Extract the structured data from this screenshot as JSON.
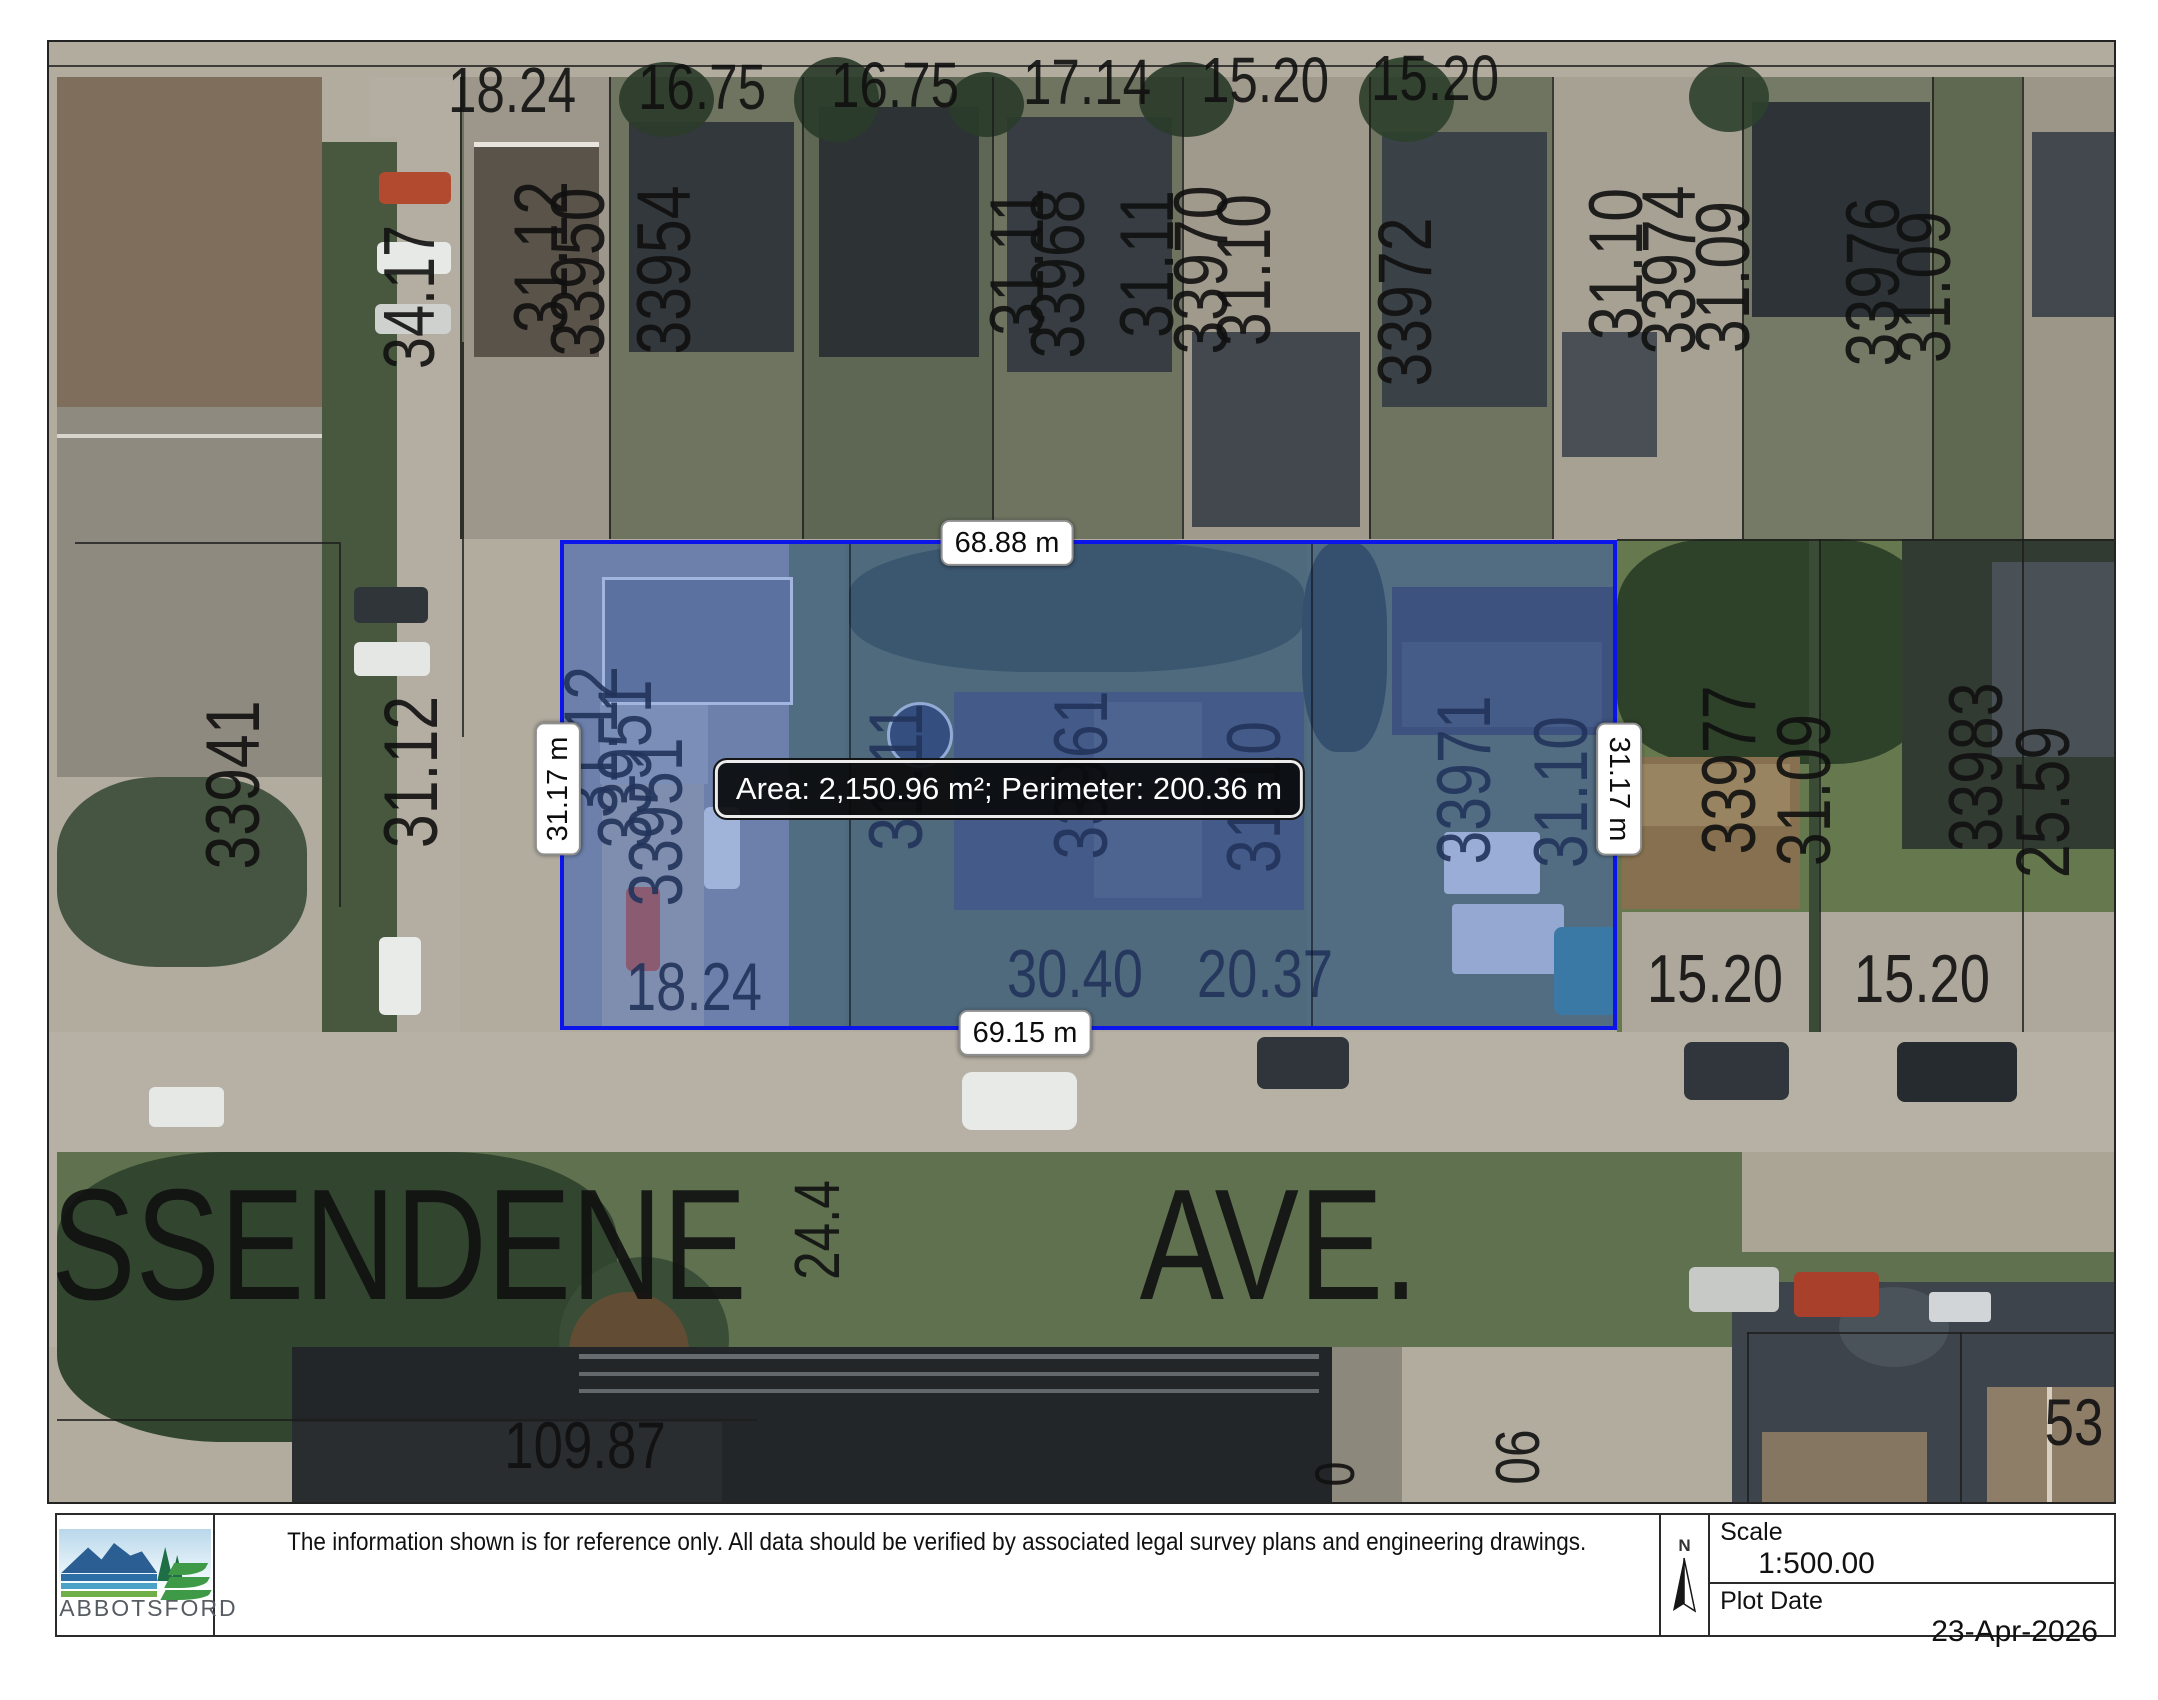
{
  "map": {
    "measurements": {
      "top": "68.88 m",
      "bottom": "69.15 m",
      "left": "31.17 m",
      "right": "31.17 m",
      "tooltip": "Area: 2,150.96 m²; Perimeter: 200.36 m"
    },
    "selection": {
      "area_m2": "2,150.96",
      "perimeter_m": "200.36"
    },
    "street_name": "SSENDENE  AVE.",
    "labels": [
      {
        "t": "18.24",
        "x": 463,
        "y": 48,
        "s": 64,
        "r": 0
      },
      {
        "t": "16.75",
        "x": 653,
        "y": 45,
        "s": 64,
        "r": 0
      },
      {
        "t": "16.75",
        "x": 846,
        "y": 43,
        "s": 64,
        "r": 0
      },
      {
        "t": "17.14",
        "x": 1038,
        "y": 40,
        "s": 64,
        "r": 0
      },
      {
        "t": "15.20",
        "x": 1216,
        "y": 38,
        "s": 64,
        "r": 0
      },
      {
        "t": "15.20",
        "x": 1386,
        "y": 36,
        "s": 64,
        "r": 0
      },
      {
        "t": "31.12",
        "x": 493,
        "y": 215,
        "s": 76,
        "r": -90
      },
      {
        "t": "33950",
        "x": 530,
        "y": 230,
        "s": 76,
        "r": -90
      },
      {
        "t": "33954",
        "x": 616,
        "y": 228,
        "s": 76,
        "r": -90
      },
      {
        "t": "31.11",
        "x": 969,
        "y": 220,
        "s": 76,
        "r": -90
      },
      {
        "t": "33968",
        "x": 1010,
        "y": 232,
        "s": 76,
        "r": -90
      },
      {
        "t": "31.11",
        "x": 1099,
        "y": 222,
        "s": 76,
        "r": -90
      },
      {
        "t": "33970",
        "x": 1153,
        "y": 228,
        "s": 76,
        "r": -90
      },
      {
        "t": "31.10",
        "x": 1196,
        "y": 228,
        "s": 76,
        "r": -90
      },
      {
        "t": "33972",
        "x": 1357,
        "y": 260,
        "s": 76,
        "r": -90
      },
      {
        "t": "31.10",
        "x": 1568,
        "y": 222,
        "s": 76,
        "r": -90
      },
      {
        "t": "33974",
        "x": 1621,
        "y": 228,
        "s": 76,
        "r": -90
      },
      {
        "t": "31.09",
        "x": 1675,
        "y": 235,
        "s": 76,
        "r": -90
      },
      {
        "t": "33976",
        "x": 1825,
        "y": 240,
        "s": 76,
        "r": -90
      },
      {
        "t": "31.09",
        "x": 1876,
        "y": 245,
        "s": 76,
        "r": -90
      },
      {
        "t": "34.17",
        "x": 361,
        "y": 255,
        "s": 72,
        "r": -90
      },
      {
        "t": "33941",
        "x": 185,
        "y": 743,
        "s": 76,
        "r": -90
      },
      {
        "t": "31.12",
        "x": 363,
        "y": 730,
        "s": 76,
        "r": -90
      },
      {
        "t": "31.12",
        "x": 543,
        "y": 700,
        "s": 76,
        "r": -90
      },
      {
        "t": "33951",
        "x": 577,
        "y": 722,
        "s": 76,
        "r": -90
      },
      {
        "t": "33951",
        "x": 608,
        "y": 780,
        "s": 76,
        "r": -90
      },
      {
        "t": "31.11",
        "x": 848,
        "y": 735,
        "s": 76,
        "r": -90
      },
      {
        "t": "33961",
        "x": 1033,
        "y": 733,
        "s": 76,
        "r": -90
      },
      {
        "t": "31.10",
        "x": 1206,
        "y": 755,
        "s": 76,
        "r": -90
      },
      {
        "t": "33971",
        "x": 1416,
        "y": 738,
        "s": 76,
        "r": -90
      },
      {
        "t": "31.10",
        "x": 1513,
        "y": 750,
        "s": 76,
        "r": -90
      },
      {
        "t": "33977",
        "x": 1681,
        "y": 728,
        "s": 76,
        "r": -90
      },
      {
        "t": "31.09",
        "x": 1756,
        "y": 748,
        "s": 76,
        "r": -90
      },
      {
        "t": "33983",
        "x": 1928,
        "y": 725,
        "s": 76,
        "r": -90
      },
      {
        "t": "25.59",
        "x": 1995,
        "y": 760,
        "s": 76,
        "r": -90
      },
      {
        "t": "18.24",
        "x": 645,
        "y": 945,
        "s": 68,
        "r": 0
      },
      {
        "t": "30.40",
        "x": 1026,
        "y": 932,
        "s": 68,
        "r": 0
      },
      {
        "t": "20.37",
        "x": 1216,
        "y": 932,
        "s": 68,
        "r": 0
      },
      {
        "t": "15.20",
        "x": 1666,
        "y": 937,
        "s": 68,
        "r": 0
      },
      {
        "t": "15.20",
        "x": 1873,
        "y": 937,
        "s": 68,
        "r": 0
      },
      {
        "t": "SSENDENE",
        "x": 350,
        "y": 1203,
        "s": 158,
        "r": 0
      },
      {
        "t": "AVE.",
        "x": 1230,
        "y": 1203,
        "s": 158,
        "r": 0
      },
      {
        "t": "24.4",
        "x": 768,
        "y": 1188,
        "s": 64,
        "r": -90
      },
      {
        "t": "109.87",
        "x": 536,
        "y": 1403,
        "s": 66,
        "r": 0
      },
      {
        "t": "06",
        "x": 1470,
        "y": 1415,
        "s": 62,
        "r": -90
      },
      {
        "t": "0",
        "x": 1286,
        "y": 1432,
        "s": 56,
        "r": -90
      },
      {
        "t": "53",
        "x": 2025,
        "y": 1380,
        "s": 66,
        "r": 0
      }
    ]
  },
  "footer": {
    "disclaimer": "The information shown is for reference only.  All data should be verified by associated legal survey plans and engineering drawings.",
    "north_label": "N",
    "scale_label": "Scale",
    "scale_value": "1:500.00",
    "plot_date_label": "Plot Date",
    "plot_date_value": "23-Apr-2026",
    "logo_text": "ABBOTSFORD"
  },
  "colors": {
    "selection_border": "#0b15eb",
    "selection_fill": "rgba(62,105,205,0.40)",
    "chip_bg": "#ffffff",
    "tooltip_bg": "#080808",
    "tooltip_text": "#ffffff"
  }
}
